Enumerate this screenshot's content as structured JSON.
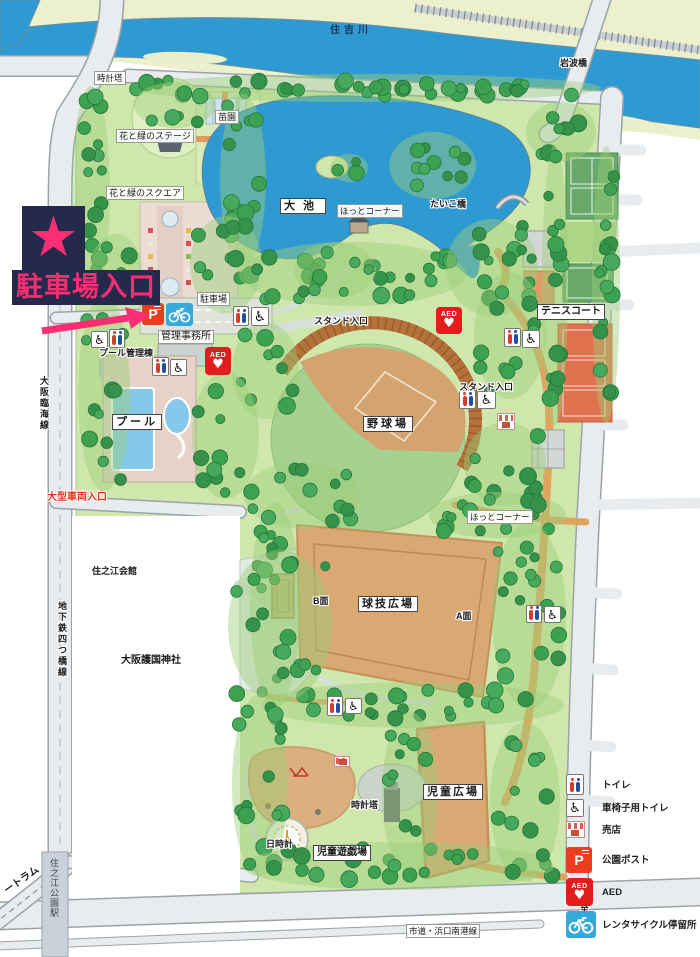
{
  "title": "住之江公園 園内マップ",
  "annotation": {
    "star": "★",
    "label": "駐車場入口",
    "accent_color": "#fb2e74",
    "box_color": "#252a4c"
  },
  "map": {
    "river": "住吉川",
    "bridge": "岩波橋",
    "facilities": {
      "clock_tower_north": "時計塔",
      "stage": "花と緑のステージ",
      "nursery": "苗園",
      "flower_square": "花と緑のスクエア",
      "big_pond": "大池",
      "hot_corner_north": "ほっとコーナー",
      "taiko_bridge": "たいこ橋",
      "tennis_court": "テニスコート",
      "parking_lot": "駐車場",
      "admin_office": "管理事務所",
      "pool_mgmt": "プール管理棟",
      "pool": "プール",
      "stand_entrance_west": "スタンド入口",
      "stand_entrance_east": "スタンド入口",
      "baseball_field": "野球場",
      "hot_corner_south": "ほっとコーナー",
      "ball_game_plaza": "球技広場",
      "side_b": "B面",
      "side_a": "A面",
      "children_plaza": "児童広場",
      "clock_tower_south": "時計塔",
      "sundial": "日時計",
      "children_playground": "児童遊戯場"
    },
    "periphery": {
      "osaka_rinkai_line": "大阪臨海線",
      "large_vehicle_entrance": "大型車両入口",
      "suminoe_hall": "住之江会館",
      "subway_yotsubashi_line": "地下鉄四つ橋線",
      "gokoku_shrine": "大阪護国神社",
      "new_tram": "ートラム",
      "suminoekoen_station": "住之江公園駅",
      "city_road": "市道・浜口南港線",
      "to_nagayoshi": "至長吉"
    }
  },
  "icons": {
    "aed_text": "AED",
    "post_letter": "P",
    "wheelchair_glyph": "♿",
    "heart_glyph": "♥"
  },
  "legend": {
    "items": [
      {
        "key": "toilet",
        "icon": "toilet-icon",
        "label": "トイレ"
      },
      {
        "key": "wheelchair-toilet",
        "icon": "wheelchair-toilet-icon",
        "label": "車椅子用トイレ"
      },
      {
        "key": "shop",
        "icon": "shop-icon",
        "label": "売店"
      },
      {
        "key": "park-post",
        "icon": "park-post-icon",
        "label": "公園ポスト"
      },
      {
        "key": "aed",
        "icon": "aed-icon",
        "label": "AED"
      },
      {
        "key": "bike-rental",
        "icon": "bike-rental-icon",
        "label": "レンタサイクル停留所"
      }
    ]
  },
  "colors": {
    "water": "#2f9ad2",
    "park_green": "#cfe7ad",
    "tree_green": "#3da152",
    "field_tan": "#d9a873",
    "accent_pink": "#fb2e74",
    "annotation_navy": "#252a4c",
    "red_text": "#e8321c",
    "aed_red": "#e11d1d",
    "post_red": "#ee3c20",
    "bike_blue": "#35a8dc"
  }
}
